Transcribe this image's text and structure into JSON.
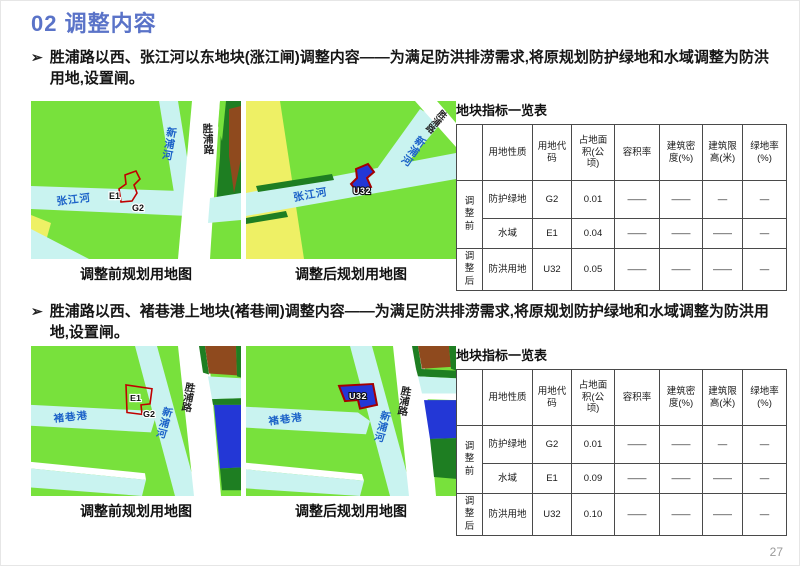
{
  "page": {
    "title": "02 调整内容",
    "page_number": "27",
    "bullet_marker": "➢"
  },
  "palette": {
    "accent_title_blue": "#5a73c8",
    "greenspace": "#78e13c",
    "water_cyan": "#c9f3f0",
    "road_white": "#ffffff",
    "dark_green": "#1e7e22",
    "brown": "#8f4a1e",
    "yellow": "#eef065",
    "flood_blue": "#2337d6",
    "parcel_outline_red": "#c00000",
    "river_label_blue": "#1b62c8"
  },
  "s1": {
    "bullet": "胜浦路以西、张江河以东地块(涨江闸)调整内容——为满足防洪排涝需求,将原规划防护绿地和水域调整为防洪用地,设置闸。",
    "caption_before": "调整前规划用地图",
    "caption_after": "调整后规划用地图",
    "map_before": {
      "river_main": "张江河",
      "river_cross": "新浦河",
      "road": "胜浦路",
      "parcel_label_1": "E1",
      "parcel_label_2": "G2"
    },
    "map_after": {
      "river_main": "张江河",
      "river_cross": "新浦河",
      "road": "胜浦路",
      "parcel_label": "U32"
    },
    "table": {
      "title": "地块指标一览表",
      "headers": [
        "用地性质",
        "用地代码",
        "占地面积(公顷)",
        "容积率",
        "建筑密度(%)",
        "建筑限高(米)",
        "绿地率(%)"
      ],
      "group_before": "调整前",
      "group_after": "调整后",
      "rows": [
        {
          "nature": "防护绿地",
          "code": "G2",
          "area": "0.01",
          "far": "——",
          "density": "——",
          "height": "—",
          "green": "—"
        },
        {
          "nature": "水域",
          "code": "E1",
          "area": "0.04",
          "far": "——",
          "density": "——",
          "height": "——",
          "green": "—"
        },
        {
          "nature": "防洪用地",
          "code": "U32",
          "area": "0.05",
          "far": "——",
          "density": "——",
          "height": "——",
          "green": "—"
        }
      ]
    }
  },
  "s2": {
    "bullet": "胜浦路以西、褚巷港上地块(褚巷闸)调整内容——为满足防洪排涝需求,将原规划防护绿地和水域调整为防洪用地,设置闸。",
    "caption_before": "调整前规划用地图",
    "caption_after": "调整后规划用地图",
    "map_before": {
      "river_main": "褚巷港",
      "river_cross": "新浦河",
      "road": "胜浦路",
      "parcel_label_1": "E1",
      "parcel_label_2": "G2"
    },
    "map_after": {
      "river_main": "褚巷港",
      "river_cross": "新浦河",
      "road": "胜浦路",
      "parcel_label": "U32"
    },
    "table": {
      "title": "地块指标一览表",
      "headers": [
        "用地性质",
        "用地代码",
        "占地面积(公顷)",
        "容积率",
        "建筑密度(%)",
        "建筑限高(米)",
        "绿地率(%)"
      ],
      "group_before": "调整前",
      "group_after": "调整后",
      "rows": [
        {
          "nature": "防护绿地",
          "code": "G2",
          "area": "0.01",
          "far": "——",
          "density": "——",
          "height": "—",
          "green": "—"
        },
        {
          "nature": "水域",
          "code": "E1",
          "area": "0.09",
          "far": "——",
          "density": "——",
          "height": "——",
          "green": "—"
        },
        {
          "nature": "防洪用地",
          "code": "U32",
          "area": "0.10",
          "far": "——",
          "density": "——",
          "height": "——",
          "green": "—"
        }
      ]
    }
  }
}
